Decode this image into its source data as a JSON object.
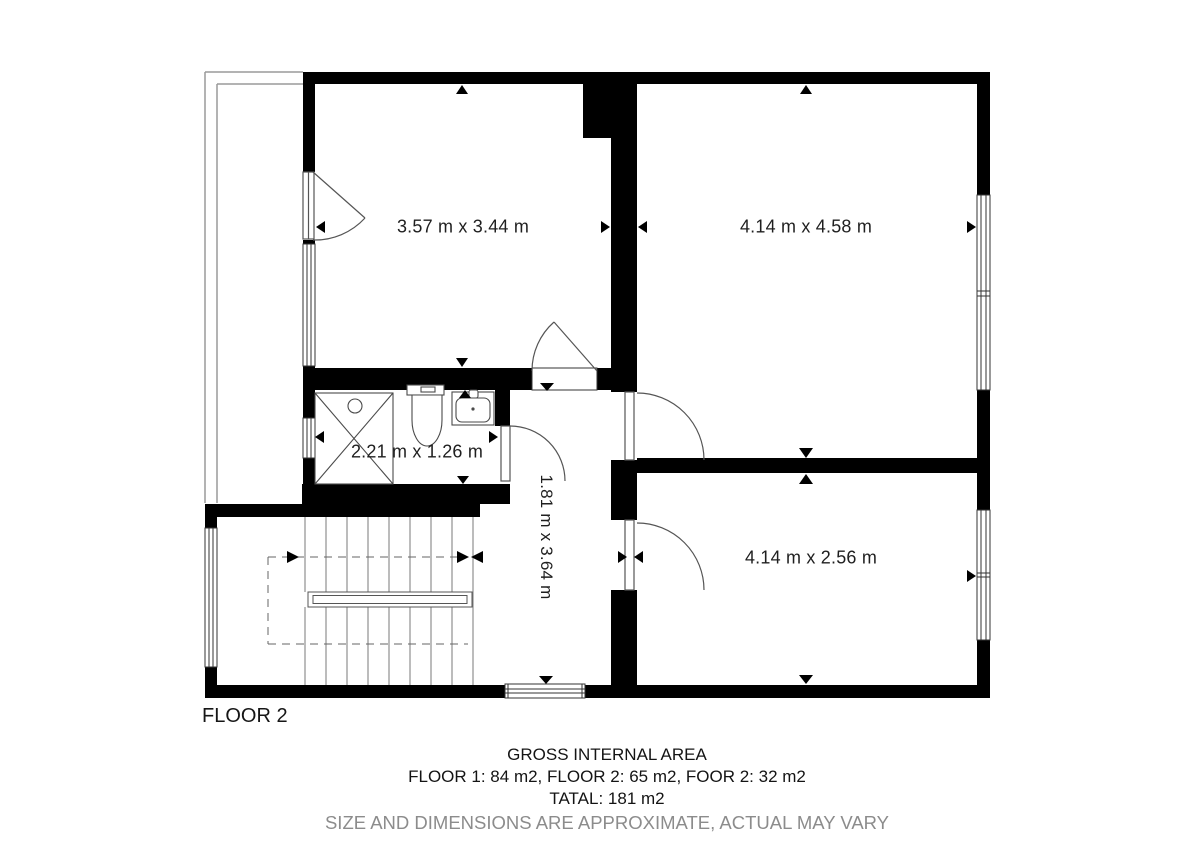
{
  "plan": {
    "floor_label": "FLOOR 2",
    "rooms": [
      {
        "id": "room-top-left",
        "dimensions": "3.57 m x 3.44 m"
      },
      {
        "id": "room-top-right",
        "dimensions": "4.14 m x 4.58 m"
      },
      {
        "id": "bathroom",
        "dimensions": "2.21 m x 1.26 m"
      },
      {
        "id": "hallway",
        "dimensions": "1.81 m x 3.64 m"
      },
      {
        "id": "room-bottom-right",
        "dimensions": "4.14 m x 2.56 m"
      }
    ]
  },
  "footer": {
    "title": "GROSS INTERNAL AREA",
    "areas": "FLOOR 1: 84 m2, FLOOR 2: 65 m2, FOOR 2: 32 m2",
    "total": "TATAL: 181 m2",
    "disclaimer": "SIZE AND DIMENSIONS ARE APPROXIMATE, ACTUAL MAY VARY"
  },
  "colors": {
    "wall": "#000000",
    "background": "#ffffff",
    "thin_line": "#4a4a4a",
    "stair_line": "#7a7a7a",
    "balcony_line": "#9a9a9a",
    "disclaimer_gray": "#8c8c8c"
  }
}
